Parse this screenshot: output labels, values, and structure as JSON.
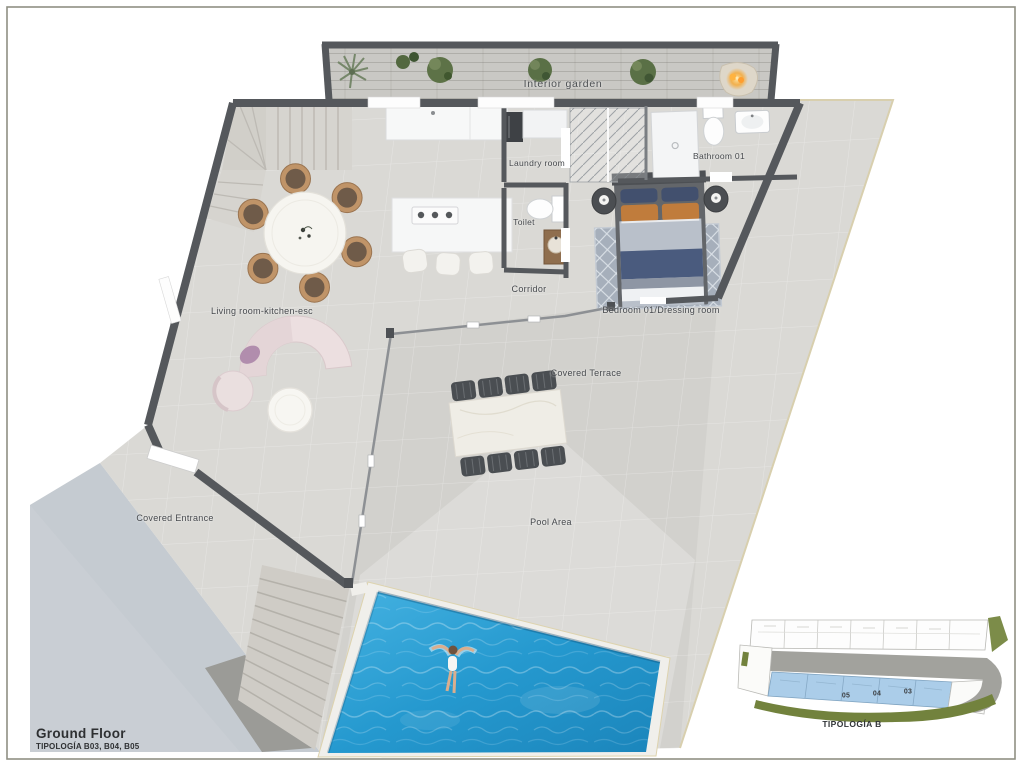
{
  "title_block": {
    "title": "Ground Floor",
    "subtitle": "TIPOLOGÍA B03, B04, B05"
  },
  "plan": {
    "rooms": [
      {
        "id": "interior-garden",
        "label": "Interior garden"
      },
      {
        "id": "laundry-room",
        "label": "Laundry room"
      },
      {
        "id": "bathroom-01",
        "label": "Bathroom 01"
      },
      {
        "id": "toilet",
        "label": "Toilet"
      },
      {
        "id": "corridor",
        "label": "Corridor"
      },
      {
        "id": "bedroom-01",
        "label": "Bedroom 01/Dressing room"
      },
      {
        "id": "living-room",
        "label": "Living room-kitchen-esc"
      },
      {
        "id": "covered-terrace",
        "label": "Covered Terrace"
      },
      {
        "id": "covered-entrance",
        "label": "Covered Entrance"
      },
      {
        "id": "pool-area",
        "label": "Pool Area"
      }
    ]
  },
  "inset": {
    "unit_numbers": [
      "05",
      "04",
      "03"
    ],
    "caption": "TIPOLOGÍA B"
  },
  "colors": {
    "wall": "#55585c",
    "floor": "#d9d8d4",
    "street": "#c9ced4",
    "pool_water": "#2a9fd6",
    "highlighted_units": "#abcde9",
    "landscape_green": "#72823d",
    "fire_accent": "#f59d2d"
  }
}
